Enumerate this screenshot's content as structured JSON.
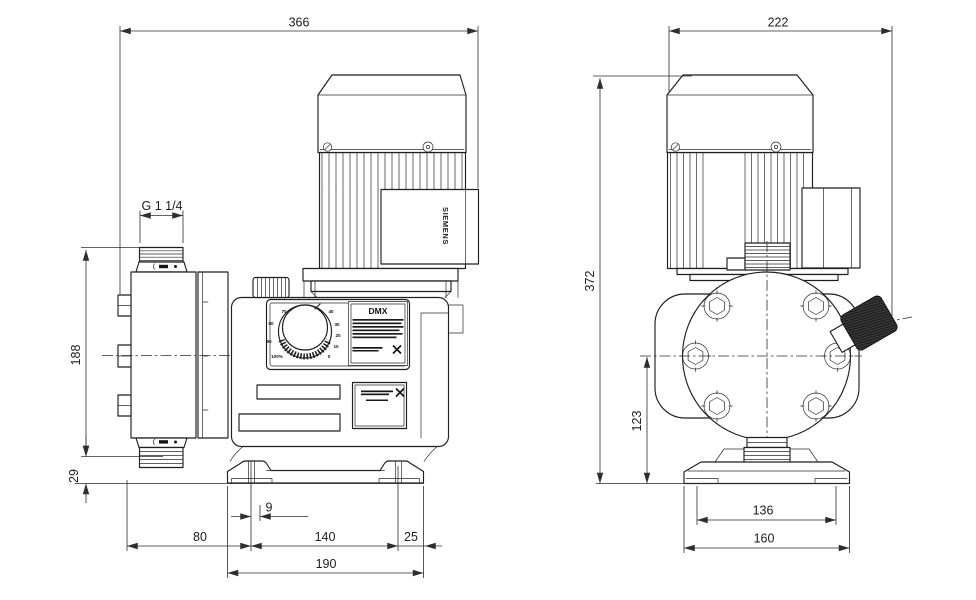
{
  "side_view": {
    "dims": {
      "overall_depth": "366",
      "thread_size": "G 1 1/4",
      "head_height": "188",
      "foot_height": "29",
      "slot_width": "9",
      "head_to_slot": "80",
      "slot_spacing": "140",
      "slot_to_edge": "25",
      "base_depth": "190"
    },
    "motor_brand": "SIEMENS",
    "model_label": "DMX",
    "dial": {
      "left": [
        "70",
        "80",
        "90",
        "100%"
      ],
      "right": [
        "40",
        "30",
        "20",
        "10",
        "0"
      ]
    }
  },
  "front_view": {
    "dims": {
      "overall_width": "222",
      "overall_height": "372",
      "center_height": "123",
      "feet_spacing": "136",
      "base_width": "160"
    }
  }
}
